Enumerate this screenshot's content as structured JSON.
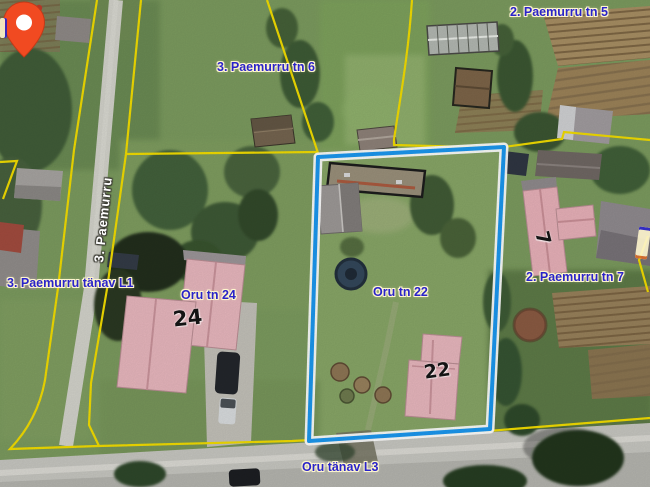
{
  "map": {
    "labels": {
      "parcel_tn5": "2. Paemurru tn 5",
      "parcel_tn6": "3. Paemurru tn 6",
      "street_paemurru": "3. Paemurru",
      "street_paemurru_l1": "3. Paemurru tänav L1",
      "address_oru24": "Oru tn 24",
      "house_24": "24",
      "address_oru22": "Oru tn 22",
      "parcel_tn7": "2. Paemurru tn 7",
      "house_7": "7",
      "house_22": "22",
      "street_oru_l3": "Oru tänav L3"
    },
    "colors": {
      "cadastral_line": "#f2dc00",
      "selected_outline": "#1b97ee",
      "selected_casing": "#ffffff",
      "label_blue": "#2a23c9",
      "label_halo": "#fdf5cd",
      "street_label_white": "#ffffff",
      "house_number_black": "#141414",
      "marker_red": "#f14a21",
      "roof_pink": "#e7b6bd"
    }
  }
}
